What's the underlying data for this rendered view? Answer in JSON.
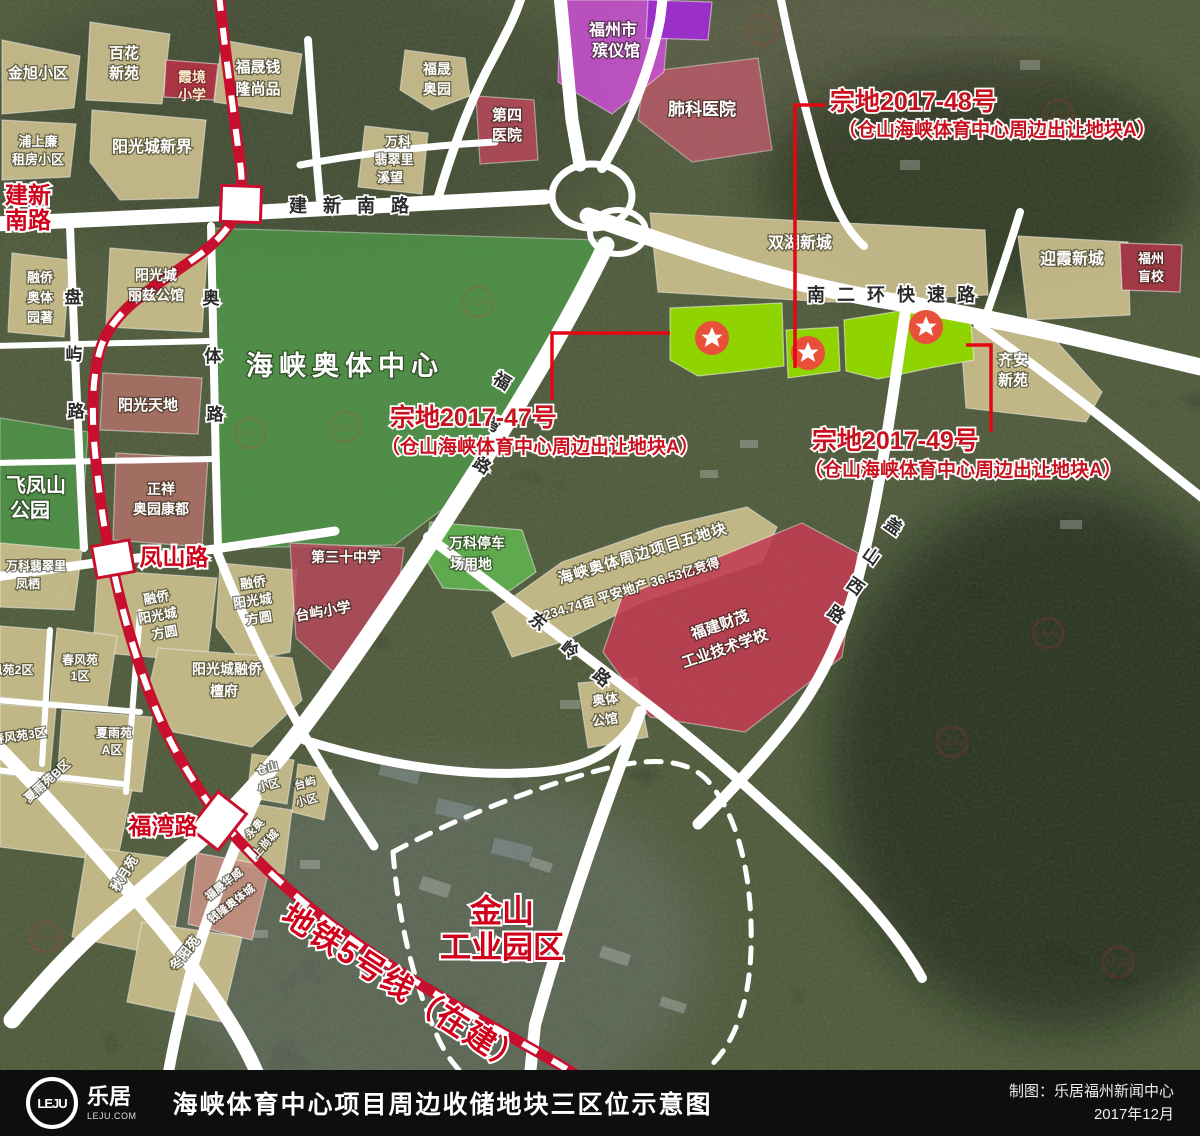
{
  "watermark": "LEJU",
  "roads": {
    "jianxin_nanlu": "建新南路",
    "nanerhuan": "南二环快速路",
    "panyu": [
      "盘",
      "屿",
      "路"
    ],
    "aotilu": [
      "奥",
      "体",
      "路"
    ],
    "fuwanlu": [
      "福",
      "湾",
      "路"
    ],
    "dongling": [
      "东",
      "岭",
      "路"
    ],
    "gaishan": [
      "盖",
      "山",
      "西",
      "路"
    ]
  },
  "metro": {
    "line5": "地铁5号线（在建）",
    "stations": {
      "jianxin": [
        "建新",
        "南路"
      ],
      "fengshan": "凤山路",
      "fuwan": "福湾路"
    }
  },
  "zongdi": {
    "z47": [
      "宗地2017-47号",
      "（仓山海峡体育中心周边出让地块A）"
    ],
    "z48": [
      "宗地2017-48号",
      "（仓山海峡体育中心周边出让地块A）"
    ],
    "z49": [
      "宗地2017-49号",
      "（仓山海峡体育中心周边出让地块A）"
    ]
  },
  "areas": {
    "jinxu": "金旭小区",
    "baihua": [
      "百花",
      "新苑"
    ],
    "xiajing": [
      "霞境",
      "小学"
    ],
    "fushengqld": [
      "福晟钱",
      "隆尚品"
    ],
    "pushang": [
      "浦上廉",
      "租房小区"
    ],
    "ygcxinjie": "阳光城新界",
    "fushengaoyuan": [
      "福晟",
      "奥园"
    ],
    "wkxiwang": [
      "万科",
      "翡翠里",
      "溪望"
    ],
    "disiyiyuan": [
      "第四",
      "医院"
    ],
    "binyiguan": [
      "福州市",
      "殡仪馆"
    ],
    "feikeyiyuan": "肺科医院",
    "shuanghu": "双湖新城",
    "yingxia": "迎霞新城",
    "mangxiao": [
      "福州",
      "盲校"
    ],
    "qianxinyuan": [
      "齐安",
      "新苑"
    ],
    "aotizhongxin": "海峡奥体中心",
    "feifengshan": [
      "飞凤山",
      "公园"
    ],
    "rongqiaoyuanzhu": [
      "融侨",
      "奥体",
      "园著"
    ],
    "lizigongguan": [
      "阳光城",
      "丽兹公馆"
    ],
    "yangguangtiandi": "阳光天地",
    "zhengxiang": [
      "正祥",
      "奥园康都"
    ],
    "wkfengqi": [
      "万科翡翠里",
      "凤栖"
    ],
    "rqfangyuan_w": [
      "融侨",
      "阳光城",
      "方圆"
    ],
    "rqfangyuan_e": [
      "融侨",
      "阳光城",
      "方圆"
    ],
    "di30zhongxue": "第三十中学",
    "taiyuxiaoxue": "台屿小学",
    "wkparking": [
      "万科停车",
      "场用地"
    ],
    "wudikuai": [
      "海峡奥体周边项目五地块",
      "234.74亩  平安地产  36.53亿竞得"
    ],
    "caimao": [
      "福建财茂",
      "工业技术学校"
    ],
    "aotigongguan": [
      "奥体",
      "公馆"
    ],
    "tanfu": [
      "阳光城融侨",
      "檀府"
    ],
    "chunfeng2": "春风苑2区",
    "chunfeng1": [
      "春风苑",
      "1区"
    ],
    "chunfeng3": "春风苑3区",
    "xiayu_a": [
      "夏雨苑",
      "A区"
    ],
    "xiayu_b": "夏雨苑B区",
    "qiuyue": "秋月苑",
    "dongyang": "冬阳苑",
    "fshuawei": [
      "福晟华威",
      "钱隆奥体城"
    ],
    "yongao": [
      "永奥",
      "上尚城"
    ],
    "cangshanxq": [
      "仓山",
      "小区"
    ],
    "taiyuxq": [
      "台屿",
      "小区"
    ],
    "jinshan": [
      "金山",
      "工业园区"
    ]
  },
  "footer": {
    "logo_text": "LEJU",
    "brand": "乐居",
    "brand_sub": "LEJU.COM",
    "title": "海峡体育中心项目周边收储地块三区位示意图",
    "credit": "制图：乐居福州新闻中心",
    "date": "2017年12月"
  }
}
